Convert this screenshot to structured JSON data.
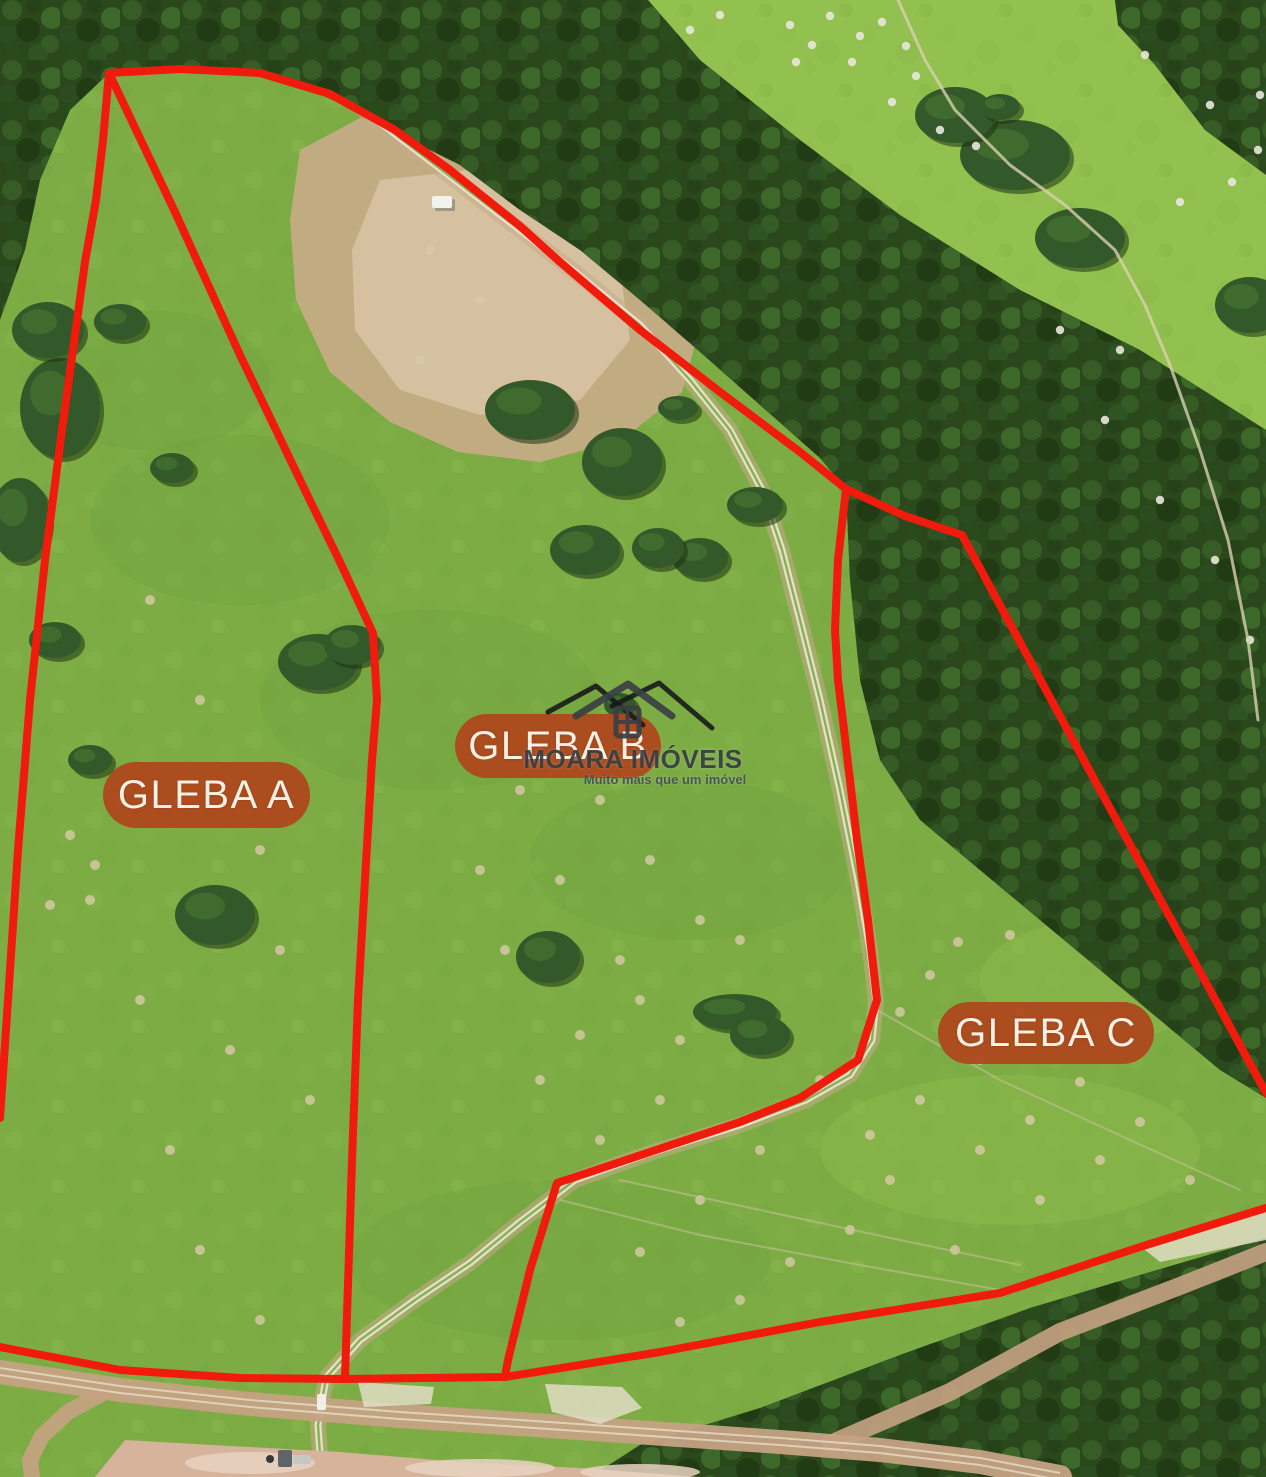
{
  "meta": {
    "width": 1266,
    "height": 1477
  },
  "colors": {
    "boundary": "#f01b0c",
    "pill_fill": "#ae481e",
    "pill_text": "#f6f0e5",
    "grass_base": "#7dac44",
    "grass_bright": "#92c14f",
    "forest": "#2b481d",
    "earth": "#c7ab88",
    "earth_light": "#d8c4a4",
    "road": "#c5a283",
    "dirt": "#d6b49c",
    "track_white": "#e9e3d0",
    "mound": "#d8cba8",
    "dot_white": "#e9e7da",
    "logo_dark": "#33383d",
    "logo_black": "#17191b"
  },
  "labels": [
    {
      "id": "gleba-a",
      "text": "GLEBA A",
      "x": 103,
      "y": 762,
      "w": 207,
      "h": 66
    },
    {
      "id": "gleba-b",
      "text": "GLEBA B",
      "x": 455,
      "y": 714,
      "w": 206,
      "h": 64
    },
    {
      "id": "gleba-c",
      "text": "GLEBA C",
      "x": 938,
      "y": 1002,
      "w": 216,
      "h": 62
    }
  ],
  "logo": {
    "title": "MOARA IMÓVEIS",
    "tagline": "Muito mais que um imóvel",
    "box": {
      "x": 500,
      "y": 660,
      "w": 266,
      "h": 140
    }
  },
  "boundaries": {
    "left": [
      [
        109,
        73
      ],
      [
        103,
        140
      ],
      [
        96,
        200
      ],
      [
        85,
        262
      ],
      [
        62,
        430
      ],
      [
        45,
        560
      ],
      [
        30,
        700
      ],
      [
        18,
        850
      ],
      [
        8,
        1000
      ],
      [
        0,
        1118
      ]
    ],
    "top": [
      [
        109,
        73
      ],
      [
        180,
        69
      ],
      [
        260,
        73
      ],
      [
        330,
        94
      ],
      [
        395,
        130
      ],
      [
        450,
        170
      ],
      [
        520,
        226
      ],
      [
        560,
        262
      ],
      [
        640,
        330
      ],
      [
        720,
        392
      ],
      [
        800,
        452
      ],
      [
        846,
        489
      ]
    ],
    "middle": [
      [
        109,
        73
      ],
      [
        175,
        212
      ],
      [
        240,
        355
      ],
      [
        300,
        480
      ],
      [
        340,
        562
      ],
      [
        373,
        633
      ],
      [
        377,
        700
      ],
      [
        372,
        760
      ],
      [
        365,
        880
      ],
      [
        358,
        1000
      ],
      [
        352,
        1160
      ],
      [
        345,
        1377
      ]
    ],
    "bc": [
      [
        846,
        489
      ],
      [
        838,
        560
      ],
      [
        835,
        630
      ],
      [
        838,
        680
      ],
      [
        850,
        780
      ],
      [
        857,
        840
      ],
      [
        868,
        920
      ],
      [
        877,
        1000
      ],
      [
        858,
        1060
      ],
      [
        800,
        1098
      ],
      [
        740,
        1122
      ],
      [
        650,
        1152
      ],
      [
        557,
        1183
      ],
      [
        530,
        1270
      ],
      [
        508,
        1360
      ],
      [
        505,
        1377
      ]
    ],
    "bottom": [
      [
        0,
        1347
      ],
      [
        120,
        1370
      ],
      [
        240,
        1378
      ],
      [
        345,
        1379
      ],
      [
        505,
        1377
      ],
      [
        660,
        1352
      ],
      [
        820,
        1322
      ],
      [
        1000,
        1293
      ],
      [
        1140,
        1247
      ],
      [
        1266,
        1208
      ]
    ],
    "c_ne": [
      [
        846,
        489
      ],
      [
        905,
        516
      ],
      [
        962,
        535
      ],
      [
        1100,
        790
      ],
      [
        1210,
        990
      ],
      [
        1266,
        1093
      ]
    ]
  },
  "scene": {
    "pasture_topright": [
      [
        648,
        0
      ],
      [
        1266,
        0
      ],
      [
        1266,
        430
      ],
      [
        1140,
        350
      ],
      [
        1020,
        290
      ],
      [
        900,
        215
      ],
      [
        800,
        140
      ],
      [
        700,
        60
      ]
    ],
    "forest_main": [
      [
        0,
        0
      ],
      [
        648,
        0
      ],
      [
        700,
        60
      ],
      [
        800,
        140
      ],
      [
        900,
        215
      ],
      [
        1020,
        290
      ],
      [
        1140,
        350
      ],
      [
        1266,
        430
      ],
      [
        1266,
        1098
      ],
      [
        1220,
        1070
      ],
      [
        1160,
        1020
      ],
      [
        1100,
        970
      ],
      [
        1040,
        920
      ],
      [
        980,
        870
      ],
      [
        920,
        820
      ],
      [
        880,
        760
      ],
      [
        860,
        680
      ],
      [
        850,
        580
      ],
      [
        846,
        489
      ],
      [
        820,
        458
      ],
      [
        760,
        405
      ],
      [
        700,
        352
      ],
      [
        640,
        300
      ],
      [
        580,
        250
      ],
      [
        520,
        210
      ],
      [
        460,
        165
      ],
      [
        400,
        135
      ],
      [
        350,
        108
      ],
      [
        300,
        85
      ],
      [
        240,
        70
      ],
      [
        180,
        68
      ],
      [
        109,
        73
      ],
      [
        70,
        110
      ],
      [
        40,
        180
      ],
      [
        25,
        250
      ],
      [
        0,
        320
      ]
    ],
    "forest_bottom": [
      [
        590,
        1477
      ],
      [
        640,
        1445
      ],
      [
        760,
        1408
      ],
      [
        900,
        1355
      ],
      [
        1030,
        1308
      ],
      [
        1150,
        1272
      ],
      [
        1266,
        1238
      ],
      [
        1266,
        1477
      ]
    ],
    "corner_woods": [
      [
        1115,
        0
      ],
      [
        1266,
        0
      ],
      [
        1266,
        175
      ],
      [
        1205,
        130
      ],
      [
        1155,
        65
      ],
      [
        1118,
        25
      ]
    ],
    "shade_blobs": [
      [
        430,
        700,
        170,
        90
      ],
      [
        240,
        520,
        150,
        85
      ],
      [
        560,
        1260,
        210,
        80
      ],
      [
        150,
        380,
        120,
        70
      ],
      [
        690,
        860,
        160,
        80
      ]
    ],
    "light_blobs": [
      [
        1010,
        1150,
        190,
        75
      ],
      [
        1100,
        980,
        120,
        60
      ]
    ],
    "bare_patch": [
      [
        300,
        150
      ],
      [
        360,
        118
      ],
      [
        450,
        124
      ],
      [
        540,
        150
      ],
      [
        620,
        190
      ],
      [
        680,
        250
      ],
      [
        702,
        320
      ],
      [
        682,
        392
      ],
      [
        622,
        440
      ],
      [
        540,
        462
      ],
      [
        458,
        452
      ],
      [
        390,
        422
      ],
      [
        330,
        372
      ],
      [
        296,
        300
      ],
      [
        290,
        220
      ]
    ],
    "bare_patch_inner": [
      [
        380,
        180
      ],
      [
        470,
        170
      ],
      [
        560,
        210
      ],
      [
        620,
        270
      ],
      [
        630,
        340
      ],
      [
        580,
        400
      ],
      [
        480,
        415
      ],
      [
        400,
        390
      ],
      [
        355,
        330
      ],
      [
        352,
        250
      ]
    ],
    "truck": {
      "x": 432,
      "y": 196,
      "w": 20,
      "h": 12
    },
    "track": [
      [
        345,
        95
      ],
      [
        400,
        138
      ],
      [
        455,
        180
      ],
      [
        520,
        230
      ],
      [
        575,
        272
      ],
      [
        640,
        325
      ],
      [
        690,
        380
      ],
      [
        730,
        430
      ],
      [
        762,
        490
      ],
      [
        782,
        550
      ],
      [
        800,
        620
      ],
      [
        820,
        700
      ],
      [
        840,
        790
      ],
      [
        858,
        880
      ],
      [
        870,
        950
      ],
      [
        876,
        1000
      ],
      [
        872,
        1040
      ],
      [
        850,
        1075
      ],
      [
        806,
        1100
      ],
      [
        740,
        1125
      ],
      [
        650,
        1153
      ],
      [
        575,
        1180
      ],
      [
        520,
        1222
      ],
      [
        470,
        1263
      ],
      [
        415,
        1300
      ],
      [
        360,
        1340
      ],
      [
        326,
        1378
      ],
      [
        318,
        1425
      ],
      [
        320,
        1455
      ]
    ],
    "gravel_patches": [
      [
        [
          545,
          1384
        ],
        [
          622,
          1387
        ],
        [
          642,
          1408
        ],
        [
          600,
          1424
        ],
        [
          552,
          1412
        ]
      ],
      [
        [
          358,
          1382
        ],
        [
          434,
          1387
        ],
        [
          431,
          1404
        ],
        [
          364,
          1407
        ]
      ],
      [
        [
          1140,
          1246
        ],
        [
          1240,
          1212
        ],
        [
          1266,
          1210
        ],
        [
          1266,
          1240
        ],
        [
          1160,
          1262
        ]
      ]
    ],
    "roads": {
      "main": [
        [
          0,
          1372
        ],
        [
          120,
          1390
        ],
        [
          250,
          1404
        ],
        [
          400,
          1416
        ],
        [
          520,
          1424
        ],
        [
          650,
          1433
        ],
        [
          780,
          1442
        ],
        [
          880,
          1450
        ],
        [
          980,
          1462
        ],
        [
          1060,
          1477
        ]
      ],
      "branch_up": [
        [
          830,
          1444
        ],
        [
          950,
          1392
        ],
        [
          1060,
          1332
        ],
        [
          1180,
          1286
        ],
        [
          1266,
          1252
        ]
      ],
      "branch_down": [
        [
          105,
          1392
        ],
        [
          68,
          1412
        ],
        [
          42,
          1436
        ],
        [
          30,
          1460
        ],
        [
          32,
          1477
        ]
      ]
    },
    "dirt_area": [
      [
        95,
        1477
      ],
      [
        125,
        1440
      ],
      [
        230,
        1446
      ],
      [
        340,
        1452
      ],
      [
        460,
        1462
      ],
      [
        580,
        1468
      ],
      [
        700,
        1477
      ]
    ],
    "dirt_patches": [
      [
        250,
        1463,
        65,
        11
      ],
      [
        480,
        1468,
        75,
        9
      ],
      [
        640,
        1472,
        60,
        8
      ]
    ],
    "objects": {
      "rig": {
        "x": 278,
        "y": 1450,
        "w": 14,
        "h": 17
      },
      "trailer": {
        "x": 293,
        "y": 1455,
        "w": 18,
        "h": 9
      },
      "dot": {
        "x": 270,
        "y": 1459,
        "r": 4
      },
      "culvert": {
        "x": 317,
        "y": 1394,
        "w": 9,
        "h": 16
      }
    },
    "path_topright": [
      [
        898,
        0
      ],
      [
        925,
        60
      ],
      [
        955,
        110
      ],
      [
        1010,
        165
      ],
      [
        1065,
        205
      ],
      [
        1115,
        250
      ],
      [
        1145,
        305
      ],
      [
        1170,
        365
      ],
      [
        1200,
        450
      ],
      [
        1228,
        540
      ],
      [
        1248,
        640
      ],
      [
        1258,
        720
      ]
    ],
    "trails": [
      [
        [
          877,
          1010
        ],
        [
          1000,
          1080
        ],
        [
          1130,
          1140
        ],
        [
          1240,
          1190
        ]
      ],
      [
        [
          560,
          1200
        ],
        [
          700,
          1235
        ],
        [
          860,
          1265
        ],
        [
          1000,
          1290
        ]
      ],
      [
        [
          620,
          1180
        ],
        [
          760,
          1210
        ],
        [
          900,
          1240
        ],
        [
          1020,
          1265
        ]
      ]
    ],
    "trees": [
      [
        318,
        662,
        40,
        28
      ],
      [
        352,
        645,
        28,
        20
      ],
      [
        215,
        915,
        40,
        30
      ],
      [
        120,
        322,
        26,
        18
      ],
      [
        172,
        468,
        22,
        15
      ],
      [
        60,
        408,
        40,
        50
      ],
      [
        20,
        520,
        30,
        42
      ],
      [
        48,
        330,
        36,
        28
      ],
      [
        55,
        640,
        26,
        18
      ],
      [
        90,
        760,
        22,
        15
      ],
      [
        530,
        410,
        45,
        30
      ],
      [
        622,
        462,
        40,
        34
      ],
      [
        678,
        408,
        20,
        12
      ],
      [
        755,
        505,
        28,
        18
      ],
      [
        585,
        550,
        35,
        25
      ],
      [
        700,
        558,
        28,
        20
      ],
      [
        658,
        548,
        26,
        20
      ],
      [
        548,
        957,
        32,
        26
      ],
      [
        735,
        1012,
        42,
        18
      ],
      [
        620,
        705,
        16,
        12
      ],
      [
        760,
        1035,
        30,
        20
      ],
      [
        1015,
        155,
        55,
        35
      ],
      [
        955,
        115,
        40,
        28
      ],
      [
        1080,
        238,
        45,
        30
      ],
      [
        1000,
        107,
        20,
        13
      ],
      [
        1250,
        305,
        35,
        28
      ]
    ],
    "mounds": [
      [
        920,
        1100
      ],
      [
        980,
        1150
      ],
      [
        1040,
        1200
      ],
      [
        890,
        1180
      ],
      [
        955,
        1250
      ],
      [
        1030,
        1120
      ],
      [
        1100,
        1160
      ],
      [
        850,
        1230
      ],
      [
        790,
        1262
      ],
      [
        740,
        1300
      ],
      [
        680,
        1322
      ],
      [
        640,
        1252
      ],
      [
        700,
        1200
      ],
      [
        760,
        1150
      ],
      [
        820,
        1080
      ],
      [
        900,
        1012
      ],
      [
        958,
        942
      ],
      [
        1020,
        1012
      ],
      [
        1080,
        1082
      ],
      [
        1140,
        1122
      ],
      [
        1190,
        1180
      ],
      [
        980,
        1060
      ],
      [
        930,
        975
      ],
      [
        1010,
        935
      ],
      [
        870,
        1135
      ],
      [
        600,
        800
      ],
      [
        650,
        860
      ],
      [
        700,
        920
      ],
      [
        560,
        880
      ],
      [
        620,
        960
      ],
      [
        680,
        1040
      ],
      [
        740,
        940
      ],
      [
        540,
        1080
      ],
      [
        600,
        1140
      ],
      [
        660,
        1100
      ],
      [
        580,
        1035
      ],
      [
        640,
        1000
      ],
      [
        505,
        950
      ],
      [
        480,
        870
      ],
      [
        520,
        790
      ],
      [
        150,
        600
      ],
      [
        200,
        700
      ],
      [
        120,
        800
      ],
      [
        90,
        900
      ],
      [
        230,
        1050
      ],
      [
        170,
        1150
      ],
      [
        280,
        950
      ],
      [
        260,
        850
      ],
      [
        310,
        1100
      ],
      [
        200,
        1250
      ],
      [
        260,
        1320
      ],
      [
        140,
        1000
      ],
      [
        70,
        835
      ],
      [
        95,
        865
      ],
      [
        50,
        905
      ],
      [
        430,
        250
      ],
      [
        480,
        300
      ],
      [
        420,
        360
      ]
    ],
    "white_dots": [
      [
        790,
        25
      ],
      [
        812,
        45
      ],
      [
        796,
        62
      ],
      [
        830,
        16
      ],
      [
        860,
        36
      ],
      [
        852,
        62
      ],
      [
        882,
        22
      ],
      [
        906,
        46
      ],
      [
        916,
        76
      ],
      [
        892,
        102
      ],
      [
        940,
        130
      ],
      [
        976,
        146
      ],
      [
        1210,
        105
      ],
      [
        1258,
        150
      ],
      [
        1232,
        182
      ],
      [
        1180,
        202
      ],
      [
        1260,
        95
      ],
      [
        1145,
        55
      ],
      [
        1105,
        420
      ],
      [
        1160,
        500
      ],
      [
        1215,
        560
      ],
      [
        1250,
        640
      ],
      [
        1120,
        350
      ],
      [
        1060,
        330
      ],
      [
        690,
        30
      ],
      [
        720,
        15
      ]
    ]
  }
}
